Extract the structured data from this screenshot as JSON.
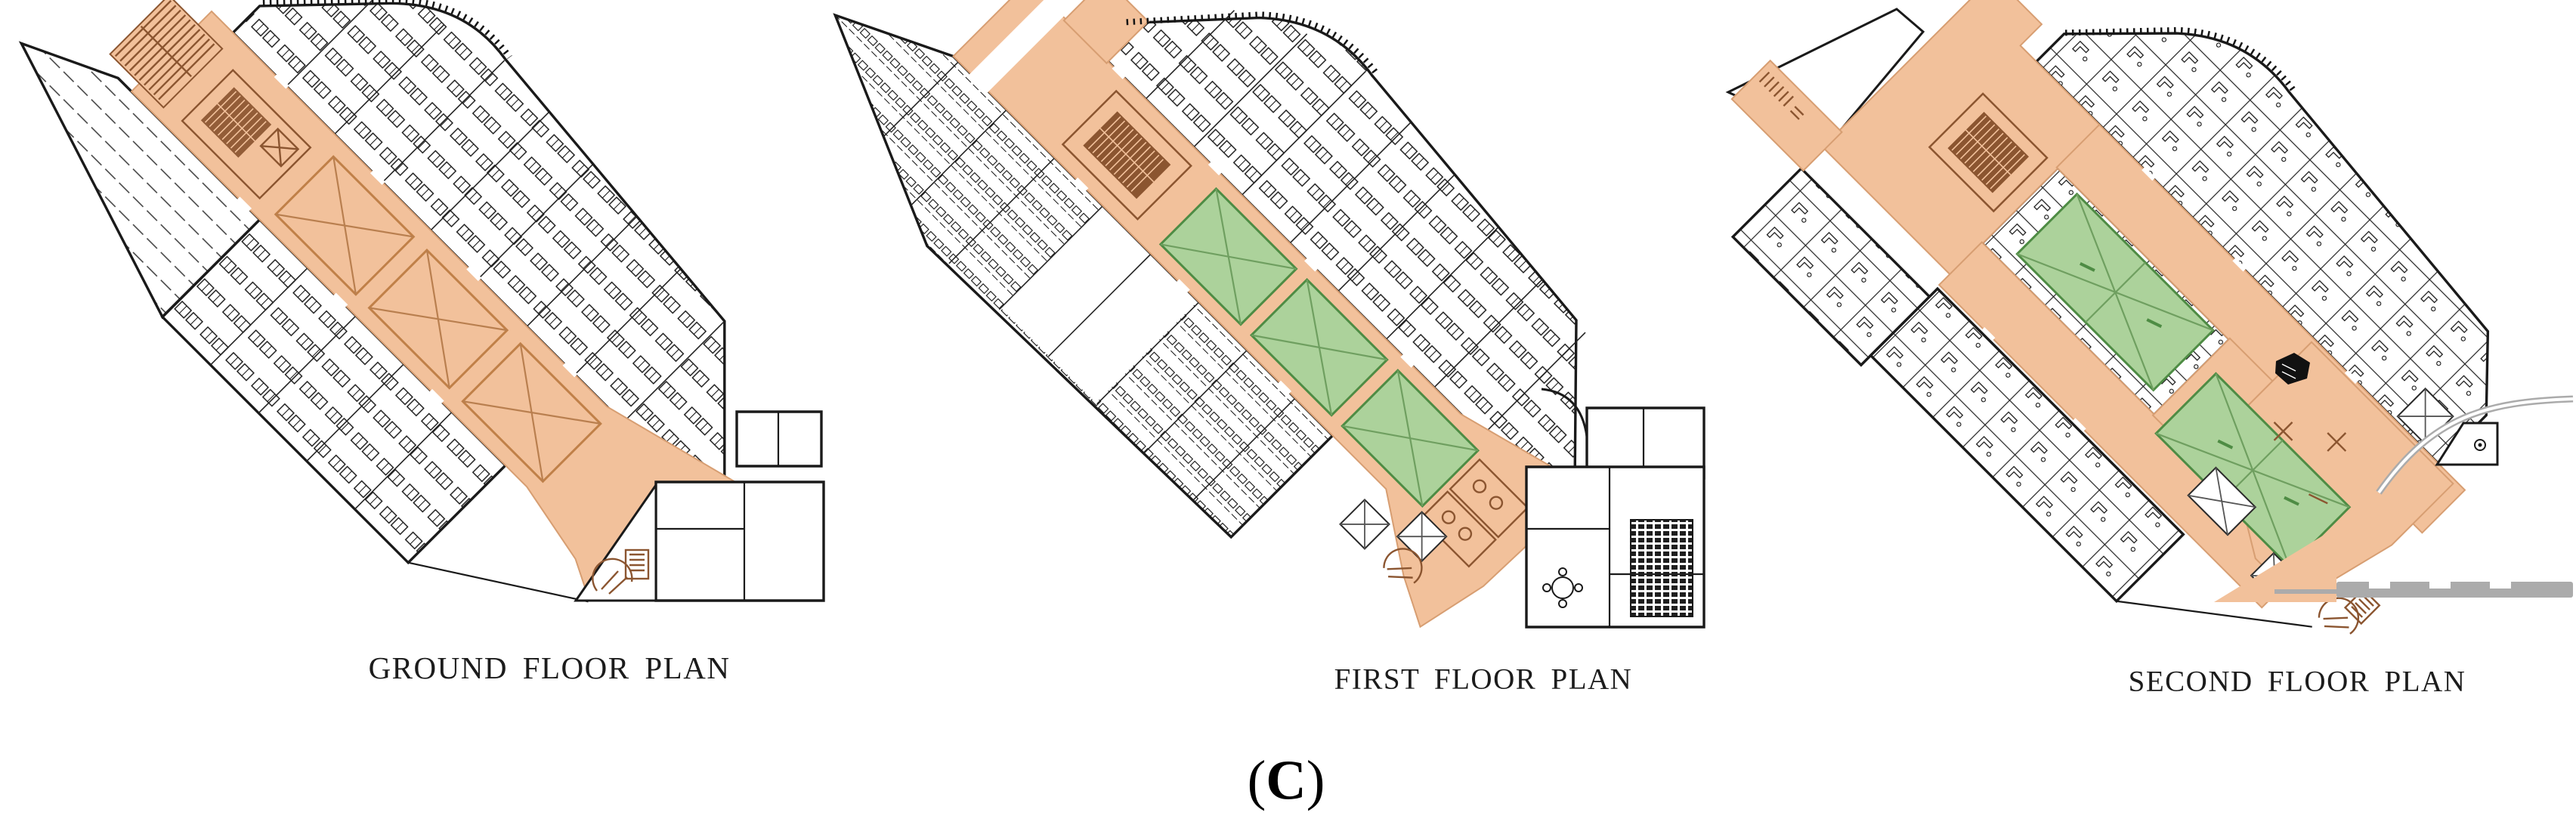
{
  "figure": {
    "plans": [
      {
        "id": "ground",
        "label": "GROUND FLOOR PLAN"
      },
      {
        "id": "first",
        "label": "FIRST FLOOR PLAN"
      },
      {
        "id": "second",
        "label": "SECOND FLOOR PLAN"
      }
    ],
    "caption": {
      "open": "(",
      "letter": "C",
      "close": ")"
    },
    "colors": {
      "corridor": "#F2C19B",
      "corridor_edge": "#D79E72",
      "void_green": "#ACD29B",
      "void_green_edge": "#4E8C44",
      "stair_brown": "#8B5530",
      "wall": "#1A1A1A",
      "road_gray": "#ABABAB"
    }
  }
}
